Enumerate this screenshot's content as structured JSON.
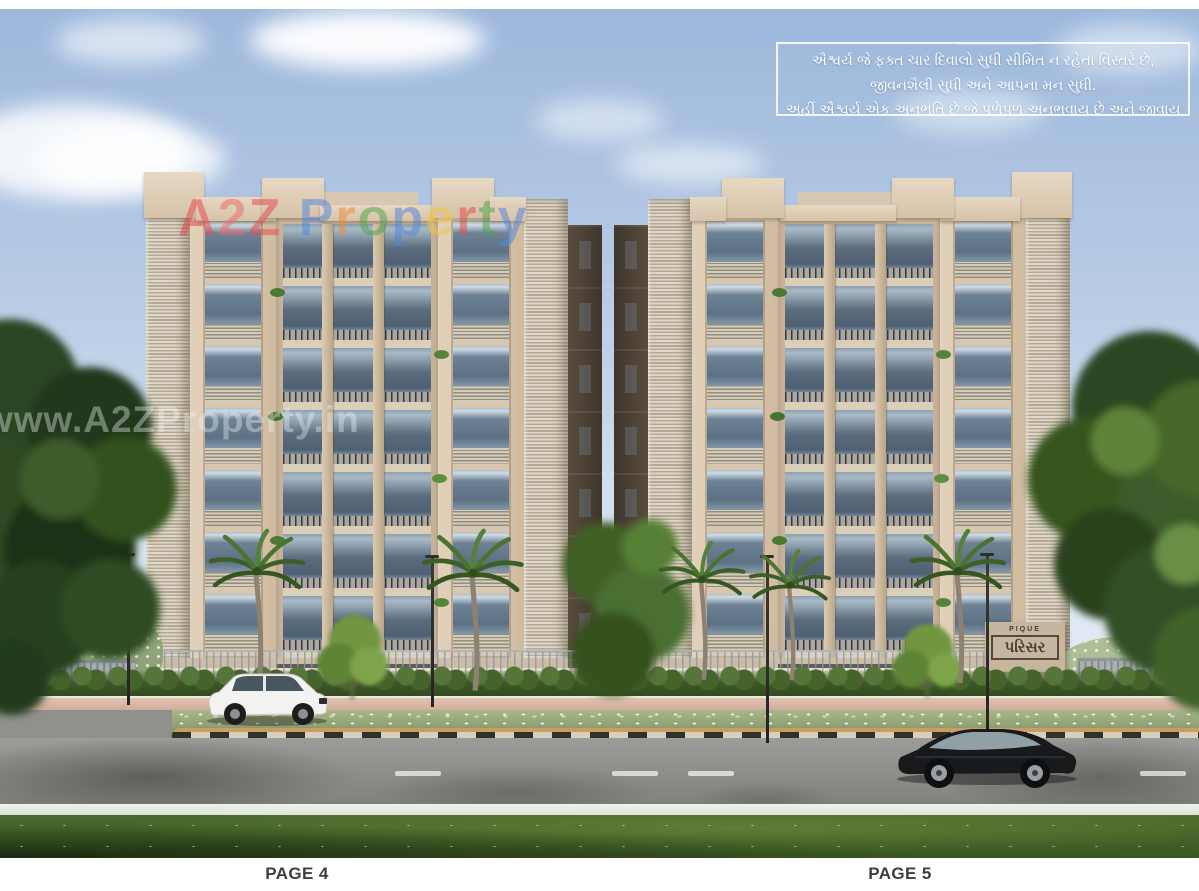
{
  "page": {
    "left_label": "PAGE 4",
    "right_label": "PAGE 5",
    "paper_color": "#ffffff"
  },
  "quote_box": {
    "lines": [
      "ઐશ્વર્ય જે ફક્ત ચાર દિવાલો સુધી સીમિત ન રહેતા વિસ્તરે છે,",
      "જીવનશૈલી સુધી અને આપના મન સુધી.",
      "અહીં ઐશ્વર્ય એક અનુભૂતિ છે જે પળેપળ અનુભવાય છે અને જીવાય છે."
    ],
    "text_color": "#ffffff",
    "border_color": "#f5f8fb"
  },
  "watermarks": {
    "brand_text": "A2Z Property",
    "brand_letters": [
      {
        "ch": "A",
        "color": "#e84a4e"
      },
      {
        "ch": "2",
        "color": "#ef6a6d"
      },
      {
        "ch": "Z",
        "color": "#e84a4e"
      },
      {
        "ch": " ",
        "color": "#ffffff"
      },
      {
        "ch": "P",
        "color": "#4f87e0"
      },
      {
        "ch": "r",
        "color": "#ef8c3a"
      },
      {
        "ch": "o",
        "color": "#4fa64b"
      },
      {
        "ch": "p",
        "color": "#4f87e0"
      },
      {
        "ch": "e",
        "color": "#f4c63f"
      },
      {
        "ch": "r",
        "color": "#e84a4e"
      },
      {
        "ch": "t",
        "color": "#4fa64b"
      },
      {
        "ch": "y",
        "color": "#4f87e0"
      }
    ],
    "site_url": "www.A2ZProperty.in"
  },
  "signboard": {
    "top_text": "PIQUE",
    "main_text": "પરિસર"
  },
  "scene_palette": {
    "sky_top": "#9db8dc",
    "sky_horizon": "#edf1f6",
    "facade": "#d9c6ae",
    "facade_recess": "#c9b49c",
    "glass": "#5d7184",
    "louvre": "#ded7c9",
    "foliage_dark": "#2b4421",
    "foliage_light": "#6f973f",
    "lawn": "#42622a",
    "road": "#8f8f8b",
    "walkway_pink": "#e0c4b1",
    "median_curb_dark": "#32302a",
    "median_curb_light": "#d8cfbc",
    "suv_color": "#f2f3f1",
    "sedan_color": "#17191b",
    "page_label_color": "#3e3e3e"
  }
}
